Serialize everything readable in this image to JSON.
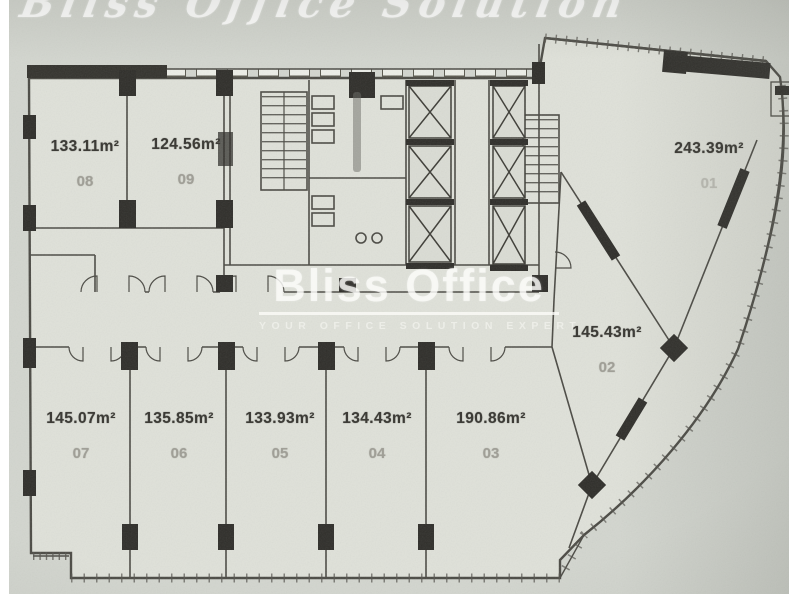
{
  "scan": {
    "script_watermark": "Bliss Office Solution",
    "brand": {
      "title": "Bliss Office",
      "tagline": "YOUR OFFICE SOLUTION EXPERT"
    }
  },
  "floorplan": {
    "type": "office-floor-plan",
    "units": [
      {
        "id": "01",
        "area": "243.39m²"
      },
      {
        "id": "02",
        "area": "145.43m²"
      },
      {
        "id": "03",
        "area": "190.86m²"
      },
      {
        "id": "04",
        "area": "134.43m²"
      },
      {
        "id": "05",
        "area": "133.93m²"
      },
      {
        "id": "06",
        "area": "135.85m²"
      },
      {
        "id": "07",
        "area": "145.07m²"
      },
      {
        "id": "08",
        "area": "133.11m²"
      },
      {
        "id": "09",
        "area": "124.56m²"
      }
    ]
  },
  "colors": {
    "paper": "#d3d6cf",
    "building_fill": "#dfe1d9",
    "wall_ink": "#4b4a44",
    "column_ink": "#2f2e2a",
    "watermark": "#ffffff",
    "unit_number": "#a09f97"
  }
}
